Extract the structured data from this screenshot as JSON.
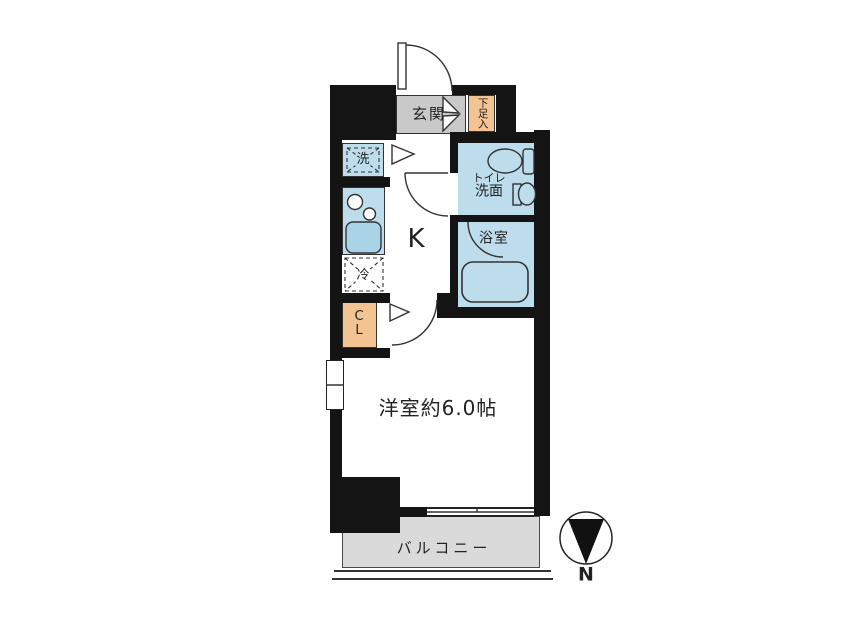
{
  "labels": {
    "entrance": "玄関",
    "shoe_cabinet": "下足入",
    "washer": "洗",
    "toilet_line1": "トイレ",
    "toilet_line2": "洗面",
    "bathroom": "浴室",
    "kitchen": "K",
    "fridge": "冷",
    "closet_line1": "C",
    "closet_line2": "L",
    "main_room": "洋室約6.0帖",
    "balcony": "バルコニー",
    "north": "N"
  },
  "colors": {
    "wall": "#141414",
    "wet-room": "#bddcec",
    "fixture": "#abd3e8",
    "entrance-floor": "#c9c9c9",
    "storage": "#f3c491",
    "balcony-floor": "#dadada",
    "line": "#333333",
    "text": "#222222"
  }
}
